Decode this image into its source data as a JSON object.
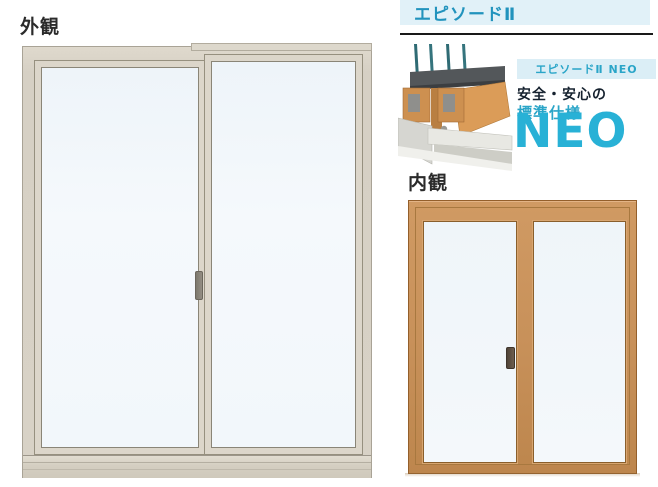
{
  "labels": {
    "exterior_view": "外観",
    "interior_view": "内観"
  },
  "header": {
    "title": "エピソードⅡ"
  },
  "feature": {
    "badge": "エピソードⅡ NEO",
    "caption_line1": "安全・安心の",
    "caption_line2": "標準仕様",
    "caption_line3": "NEO"
  },
  "colors": {
    "accent_cyan": "#2aa5c8",
    "neo_cyan": "#28b1d6",
    "title_blue": "#2193bd",
    "title_band_bg": "#e1f1f8",
    "badge_bg": "#dbeef6",
    "dark_text": "#16222f",
    "exterior_frame": "#d8d2c6",
    "interior_wood": "#c8915a",
    "glass": "#f2f7fa"
  },
  "icons": {
    "cross_section": "window-cross-section-illustration",
    "exterior_window": "sliding-window-exterior-illustration",
    "interior_window": "sliding-window-interior-illustration"
  }
}
